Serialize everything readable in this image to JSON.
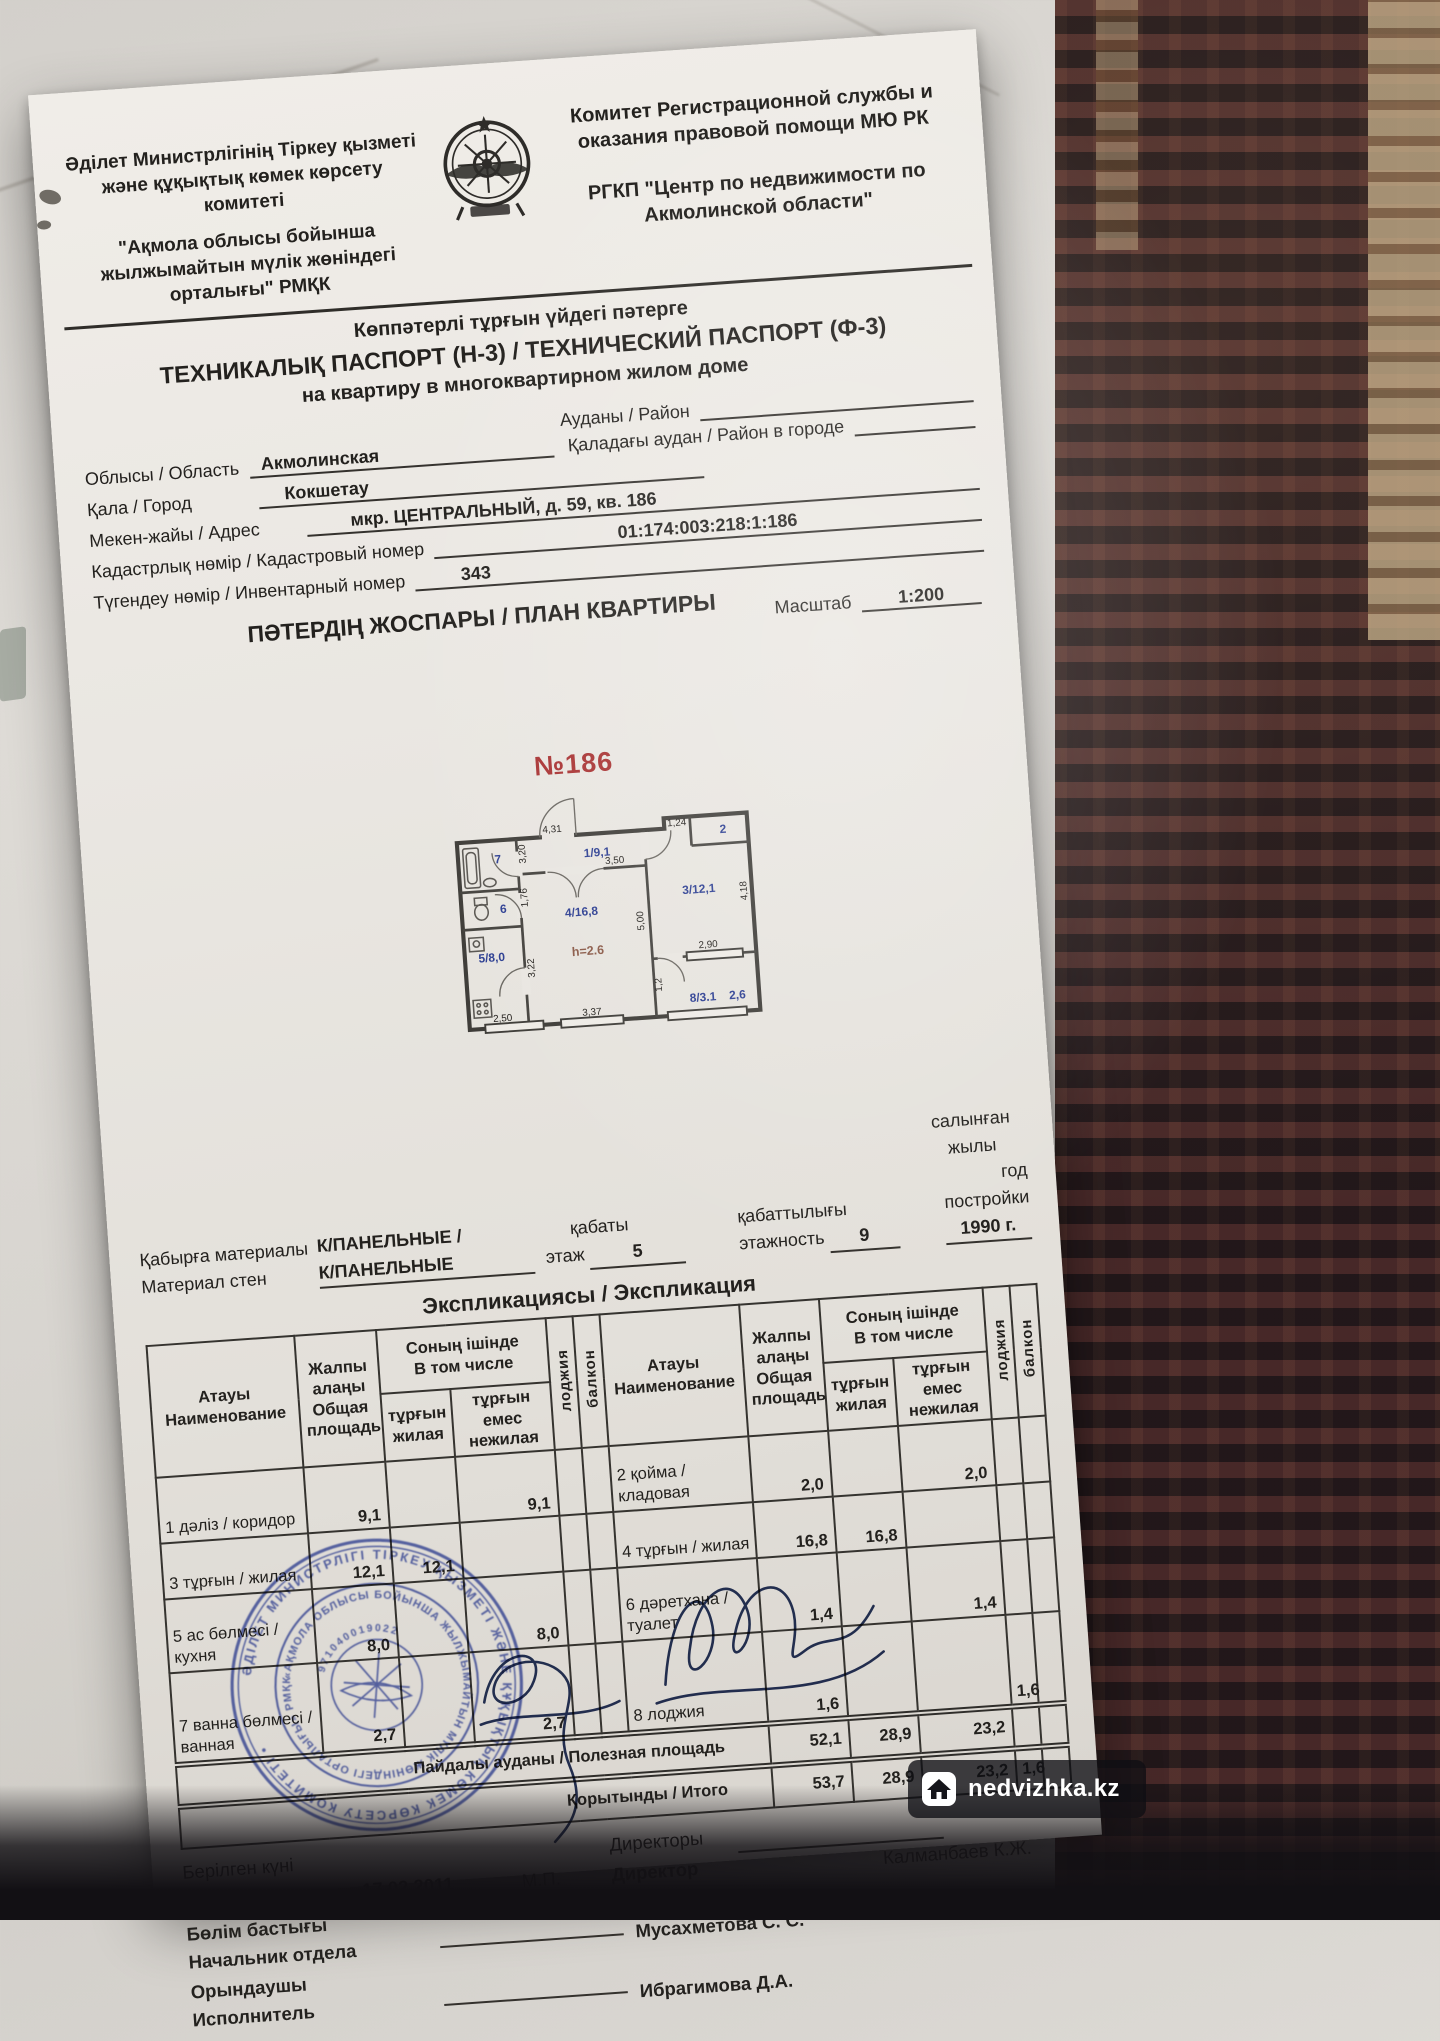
{
  "colors": {
    "stamp_blue": "#3d4fae",
    "room_label_blue": "#2d3f92",
    "unit_red": "#a83232",
    "paper": "#e9e6e1"
  },
  "header": {
    "left1": "Әділет Министрлігінің Тіркеу қызметі",
    "left2": "және құқықтық көмек көрсету комитеті",
    "left_org1": "\"Ақмола облысы бойынша",
    "left_org2": "жылжымайтын мүлік жөніндегі",
    "left_org3": "орталығы\" РМҚК",
    "right1": "Комитет Регистрационной службы и",
    "right2": "оказания правовой помощи МЮ РК",
    "right_org1": "РГКП \"Центр по недвижимости по",
    "right_org2": "Акмолинской области\""
  },
  "title": {
    "line1": "Көппәтерлі тұрғын үйдегі пәтерге",
    "line2": "ТЕХНИКАЛЫҚ ПАСПОРТ (Н-3) / ТЕХНИЧЕСКИЙ ПАСПОРТ (Ф-3)",
    "line3": "на квартиру в многоквартирном жилом доме"
  },
  "fields": {
    "district_label": "Ауданы / Район",
    "region_label": "Облысы / Область",
    "region_value": "Акмолинская",
    "city_district_label": "Қаладағы аудан / Район в городе",
    "city_label": "Қала / Город",
    "city_value": "Кокшетау",
    "address_label": "Мекен-жайы / Адрес",
    "address_value": "мкр. ЦЕНТРАЛЬНЫЙ, д. 59, кв. 186",
    "cadastral_label": "Кадастрлық нөмір / Кадастровый номер",
    "cadastral_value": "01:174:003:218:1:186",
    "inventory_label": "Түгендеу нөмір / Инвентарный номер",
    "inventory_value": "343"
  },
  "plan": {
    "section_title": "ПӘТЕРДІҢ ЖОСПАРЫ / ПЛАН КВАРТИРЫ",
    "scale_label": "Масштаб",
    "scale_value": "1:200",
    "unit_number": "№186",
    "rooms": {
      "r1": "1/9,1",
      "r2": "2",
      "r3": "3/12,1",
      "r4": "4/16,8",
      "r5": "5/8,0",
      "r6": "6",
      "r7": "7",
      "r8": "8/3.1",
      "r8b": "2,6"
    },
    "ceiling_height": "h=2.6",
    "dims": {
      "d431": "4,31",
      "d350": "3,50",
      "d124": "1,24",
      "d320": "3,20",
      "d176": "1,76",
      "d322": "3,22",
      "d500": "5,00",
      "d418": "4,18",
      "d290": "2,90",
      "d250": "2,50",
      "d337": "3,37",
      "d12": "1,2"
    }
  },
  "building": {
    "walls_label1": "Қабырға материалы",
    "walls_label2": "Материал стен",
    "walls_value1": "К/ПАНЕЛЬНЫЕ /",
    "walls_value2": "К/ПАНЕЛЬНЫЕ",
    "floor_label1": "қабаты",
    "floor_label2": "этаж",
    "floor_value": "5",
    "floors_label1": "қабаттылығы",
    "floors_label2": "этажность",
    "floors_value": "9",
    "year_label1": "салынған жылы",
    "year_label2": "год постройки",
    "year_value": "1990 г."
  },
  "explication": {
    "title": "Экспликациясы / Экспликация",
    "head": {
      "name": "Атауы\nНаименование",
      "total": "Жалпы\nалаңы\nОбщая\nплощадь",
      "incl": "Соның ішінде\nВ том числе",
      "living": "тұрғын\nжилая",
      "nonliving": "тұрғын емес\nнежилая",
      "loggia": "лоджия",
      "balcony": "балкон"
    },
    "left_rows": [
      {
        "name": "1 дәліз / коридор",
        "total": "9,1",
        "living": "",
        "nonliving": "9,1",
        "loggia": "",
        "balcony": ""
      },
      {
        "name": "3 тұрғын / жилая",
        "total": "12,1",
        "living": "12,1",
        "nonliving": "",
        "loggia": "",
        "balcony": ""
      },
      {
        "name": "5 ас бөлмесі /\nкухня",
        "total": "8,0",
        "living": "",
        "nonliving": "8,0",
        "loggia": "",
        "balcony": ""
      },
      {
        "name": "7 ванна бөлмесі /\nванная",
        "total": "2,7",
        "living": "",
        "nonliving": "2,7",
        "loggia": "",
        "balcony": ""
      }
    ],
    "right_rows": [
      {
        "name": "2  қойма / кладовая",
        "total": "2,0",
        "living": "",
        "nonliving": "2,0",
        "loggia": "",
        "balcony": ""
      },
      {
        "name": "4  тұрғын / жилая",
        "total": "16,8",
        "living": "16,8",
        "nonliving": "",
        "loggia": "",
        "balcony": ""
      },
      {
        "name": "6  дәретхана /\nтуалет",
        "total": "1,4",
        "living": "",
        "nonliving": "1,4",
        "loggia": "",
        "balcony": ""
      },
      {
        "name": "8  лоджия",
        "total": "1,6",
        "living": "",
        "nonliving": "",
        "loggia": "1,6",
        "balcony": ""
      }
    ],
    "useful_label": "Пайдалы ауданы / Полезная площадь",
    "useful": {
      "total": "52,1",
      "living": "28,9",
      "nonliving": "23,2",
      "loggia": "",
      "balcony": ""
    },
    "total_label": "Қорытынды / Итого",
    "totals": {
      "total": "53,7",
      "living": "28,9",
      "nonliving": "23,2",
      "loggia": "1,6",
      "balcony": ""
    }
  },
  "signatures": {
    "date_label1": "Берілген күні",
    "date_label2": "Дата выдачи",
    "date_value": "17.02.2011",
    "mp": "М.П.",
    "director_label1": "Директоры",
    "director_label2": "Директор",
    "director_name": "Калманбаев К.Ж.",
    "head_label1": "Бөлім бастығы",
    "head_label2": "Начальник отдела",
    "head_name": "Мусахметова С. С.",
    "executor_label1": "Орындаушы",
    "executor_label2": "Исполнитель",
    "executor_name": "Ибрагимова Д.А.",
    "stamp_outer_text": "ӘДІЛЕТ МИНИСТРЛІГІ ТІРКЕУ ҚЫЗМЕТІ ЖӘНЕ ҚҰҚЫҚТЫҚ КӨМЕК КӨРСЕТУ КОМИТЕТІ •",
    "stamp_inner_text": "«АҚМОЛА ОБЛЫСЫ БОЙЫНША ЖЫЛЖЫМАЙТЫН МҮЛІК ЖӨНІНДЕГІ ОРТАЛЫҒЫ» РМҚК",
    "stamp_number": "971040019022"
  },
  "watermark": {
    "text": "nedvizhka.kz"
  }
}
